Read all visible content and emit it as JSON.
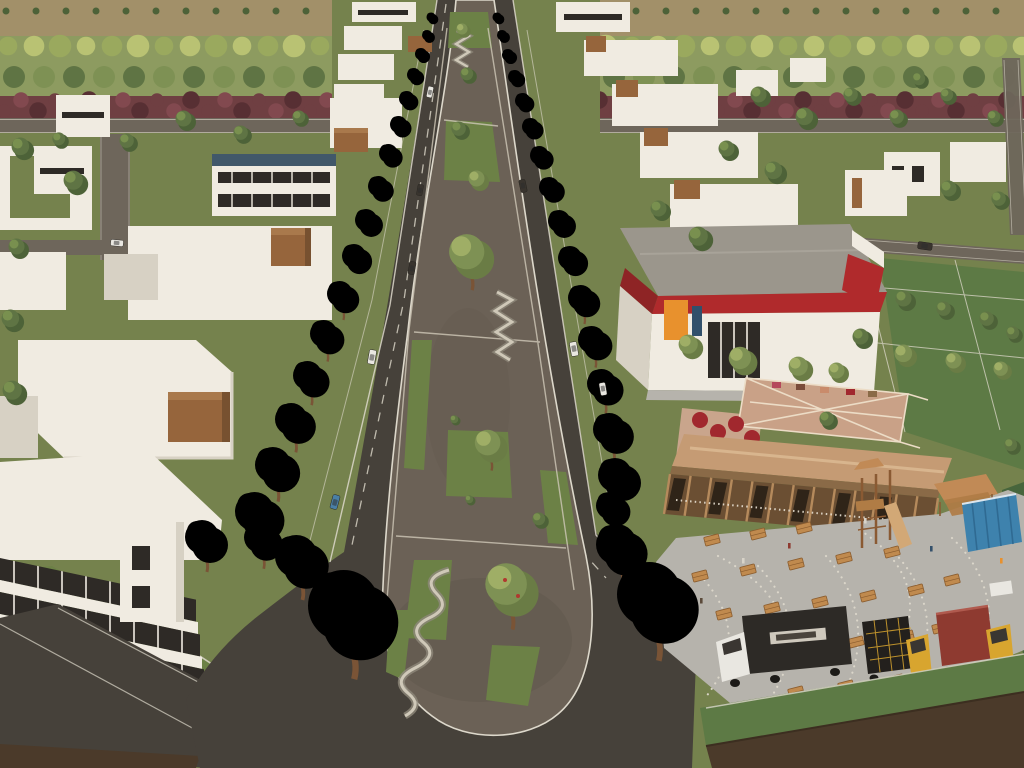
{
  "scene": {
    "medium": "3d-architectural-rendering",
    "view": "aerial-perspective",
    "setting": "master-planned residential community with central boulevard and linear park",
    "visible_text": []
  },
  "palette": {
    "field": "#a29069",
    "orchardBase": "#8d9b60",
    "treeYellow": "#b9c273",
    "treeYellowD": "#9aa95e",
    "treeOlive": "#7e9154",
    "treeOliveD": "#6a7c45",
    "treeOliveL": "#9fae66",
    "treeGreen": "#5f7444",
    "treeDark": "#4d6238",
    "treeLight": "#79904f",
    "hedge": "#6f3f42",
    "hedgeLight": "#82494f",
    "hedgeDark": "#572f33",
    "roadLight": "#6e665b",
    "asphalt": "#46413a",
    "gravel": "#6b6156",
    "gravelDark": "#5f564b",
    "plaza": "#b6b3ac",
    "path": "#cfc8b8",
    "pathShadow": "#8f887b",
    "curb": "#ddd8cb",
    "grass": "#75824d",
    "grassBright": "#6c8146",
    "lawnDark": "#5d7a45",
    "lawnDarker": "#47653c",
    "bldgWhite": "#f0ebe1",
    "bldgShade": "#d7d1c4",
    "windowDark": "#2e2a26",
    "wood": "#96653c",
    "woodTop": "#a9794c",
    "woodDark": "#775130",
    "slateRoof": "#41586a",
    "marketRoof": "#9b968c",
    "red": "#b02a2c",
    "redDark": "#8e2425",
    "orange": "#e8912d",
    "roofTan": "#c59b74",
    "roofRidge": "#d8b58e",
    "beam": "#8a6a47",
    "woodWall": "#6b4f33",
    "woodPost": "#b58a5c",
    "deck": "#c9a187",
    "deckFrame": "#ecdcc6",
    "trunk": "#7a5436",
    "umbrella": "#a1282e",
    "table": "#c08a4e",
    "tableEdge": "#8a5c2e",
    "truckBlack": "#2d2a26",
    "truckYellow": "#d8a52f",
    "truckRed": "#8e3a30",
    "container": "#3e82ad",
    "containerDark": "#2f6a92",
    "soil": "#4b3a2a",
    "soilDark": "#3c2e20",
    "carWhite": "#e9e7e1",
    "carDark": "#39342e",
    "carBlue": "#4a7fa5",
    "playWood": "#b07c45",
    "canopyTan": "#c18a56",
    "slide": "#d2a876"
  },
  "inventory": {
    "boulevard": {
      "carriageways": 2,
      "median": "linear park: gravel surface, lawn patches, serpentine seat-walls, shade trees"
    },
    "street_trees": {
      "pink_flowering": 38,
      "green_and_olive": 46
    },
    "districts": {
      "left": "white flat-roof modern houses and offices with wood roof volumes",
      "right_top": "stepped row of white flat-roof houses with wood volumes",
      "right_middle": "supermarket with gray roof, red fascia band, orange sign",
      "right_bottom": "timber food-hall with roof deck, picnic-table plaza, playground, shipping container, food trucks"
    },
    "vehicles": {
      "cars": 10,
      "food_trucks": 3
    },
    "plaza": {
      "picnic_tables": 22,
      "string_light_arcs": 7,
      "red_umbrellas": 6
    },
    "background": "farm field with orchard tree rows and a maroon hedge line"
  }
}
